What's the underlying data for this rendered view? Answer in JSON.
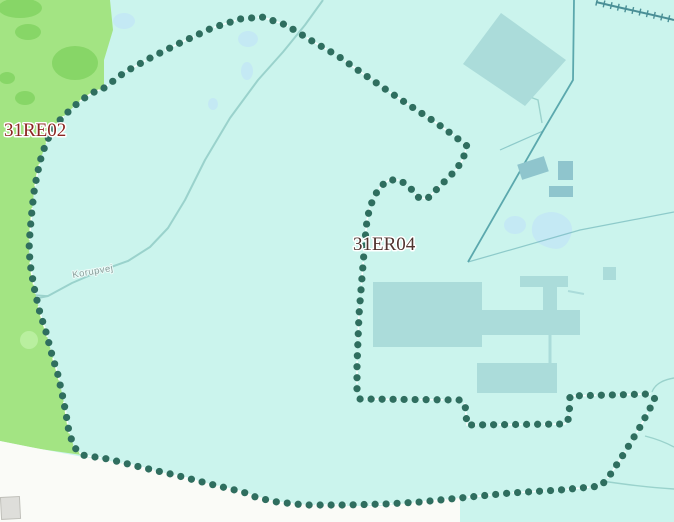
{
  "map": {
    "type": "gis-parcel-map",
    "labels": {
      "zone_left": {
        "text": "31RE02",
        "color": "#8c2622"
      },
      "zone_center": {
        "text": "31ER04",
        "color": "#503430"
      },
      "road": {
        "text": "Korupvej",
        "color": "#8aa09c"
      }
    },
    "colors": {
      "water_background": "#cbf4ed",
      "green_area": "#a3e483",
      "green_blob": "#87d667",
      "boundary_dot": "#2f6e5f",
      "building": "#abdcda",
      "pond": "#c4e9f4",
      "road_line": "#9ad2cc",
      "admin_line": "#5ba8ad",
      "outside_area": "#fafbf7",
      "zone1": "#8c2622",
      "zone2": "#503430",
      "roadtext": "#8aa09c"
    },
    "boundary_points": [
      [
        104,
        88
      ],
      [
        125,
        72
      ],
      [
        152,
        57
      ],
      [
        182,
        42
      ],
      [
        212,
        28
      ],
      [
        240,
        19
      ],
      [
        262,
        17
      ],
      [
        286,
        25
      ],
      [
        312,
        41
      ],
      [
        338,
        56
      ],
      [
        362,
        73
      ],
      [
        388,
        91
      ],
      [
        412,
        107
      ],
      [
        435,
        122
      ],
      [
        453,
        135
      ],
      [
        467,
        146
      ],
      [
        463,
        159
      ],
      [
        456,
        170
      ],
      [
        446,
        180
      ],
      [
        436,
        190
      ],
      [
        427,
        199
      ],
      [
        417,
        197
      ],
      [
        409,
        186
      ],
      [
        399,
        180
      ],
      [
        389,
        180
      ],
      [
        381,
        186
      ],
      [
        375,
        195
      ],
      [
        370,
        207
      ],
      [
        367,
        220
      ],
      [
        365,
        240
      ],
      [
        363,
        265
      ],
      [
        361,
        290
      ],
      [
        359,
        315
      ],
      [
        358,
        340
      ],
      [
        357,
        365
      ],
      [
        357,
        392
      ],
      [
        360,
        399
      ],
      [
        460,
        400
      ],
      [
        465,
        404
      ],
      [
        467,
        425
      ],
      [
        565,
        424
      ],
      [
        569,
        418
      ],
      [
        570,
        396
      ],
      [
        650,
        394
      ],
      [
        655,
        399
      ],
      [
        640,
        427
      ],
      [
        625,
        452
      ],
      [
        610,
        475
      ],
      [
        601,
        486
      ],
      [
        560,
        490
      ],
      [
        510,
        493
      ],
      [
        460,
        498
      ],
      [
        420,
        502
      ],
      [
        385,
        504
      ],
      [
        345,
        505
      ],
      [
        305,
        505
      ],
      [
        277,
        502
      ],
      [
        258,
        498
      ],
      [
        243,
        492
      ],
      [
        210,
        484
      ],
      [
        175,
        475
      ],
      [
        140,
        467
      ],
      [
        108,
        459
      ],
      [
        82,
        455
      ],
      [
        74,
        447
      ],
      [
        69,
        432
      ],
      [
        66,
        414
      ],
      [
        63,
        398
      ],
      [
        58,
        375
      ],
      [
        52,
        355
      ],
      [
        46,
        332
      ],
      [
        40,
        313
      ],
      [
        35,
        292
      ],
      [
        31,
        270
      ],
      [
        29,
        250
      ],
      [
        30,
        232
      ],
      [
        32,
        210
      ],
      [
        34,
        192
      ],
      [
        37,
        175
      ],
      [
        41,
        158
      ],
      [
        46,
        143
      ],
      [
        52,
        131
      ],
      [
        60,
        120
      ],
      [
        70,
        110
      ],
      [
        80,
        101
      ],
      [
        92,
        93
      ]
    ]
  }
}
